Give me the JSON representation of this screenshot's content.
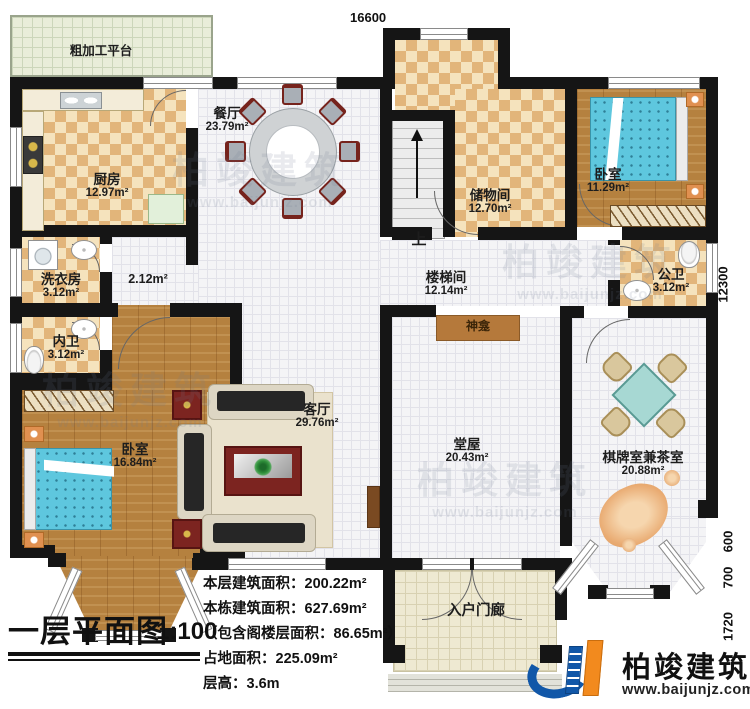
{
  "title": {
    "text": "一层平面图",
    "scale": "1:100"
  },
  "stats": {
    "lines": [
      "本层建筑面积：200.22m²",
      "本栋建筑面积：627.69m²",
      "（包含阁楼层面积：86.65m²）",
      "占地面积：225.09m²",
      "层高：3.6m"
    ]
  },
  "dimensions": {
    "top_width": "16600",
    "right_height": "12300",
    "right_segments": [
      "600",
      "700",
      "1720"
    ]
  },
  "rooms": {
    "platform": {
      "name": "粗加工平台"
    },
    "kitchen": {
      "name": "厨房",
      "area": "12.97m²"
    },
    "dining": {
      "name": "餐厅",
      "area": "23.79m²"
    },
    "storage": {
      "name": "储物间",
      "area": "12.70m²"
    },
    "bedroom_right": {
      "name": "卧室",
      "area": "11.29m²"
    },
    "bath_public": {
      "name": "公卫",
      "area": "3.12m²"
    },
    "stairwell": {
      "name": "楼梯间",
      "area": "12.14m²"
    },
    "corridor": {
      "area": "2.12m²"
    },
    "laundry": {
      "name": "洗衣房",
      "area": "3.12m²"
    },
    "bath_inner": {
      "name": "内卫",
      "area": "3.12m²"
    },
    "bedroom_left": {
      "name": "卧室",
      "area": "16.84m²"
    },
    "living": {
      "name": "客厅",
      "area": "29.76m²"
    },
    "hall": {
      "name": "堂屋",
      "area": "20.43m²"
    },
    "chess": {
      "name": "棋牌室兼茶室",
      "area": "20.88m²"
    },
    "porch": {
      "name": "入户门廊"
    }
  },
  "fixtures": {
    "shrine": "神龛",
    "stairs_up": "上"
  },
  "brand": {
    "name": "柏竣建筑",
    "website": "www.baijunjz.com"
  },
  "watermark": {
    "text": "柏竣建筑",
    "sub": "www.baijunjz.com"
  },
  "colors": {
    "wall": "#151515",
    "checker": "#e2b57a",
    "tile_floor": "#f4f4f6",
    "wood": "#b5813f",
    "bed": "#5ec7de",
    "brand_blue": "#1157a8",
    "brand_orange": "#f28a1e"
  }
}
